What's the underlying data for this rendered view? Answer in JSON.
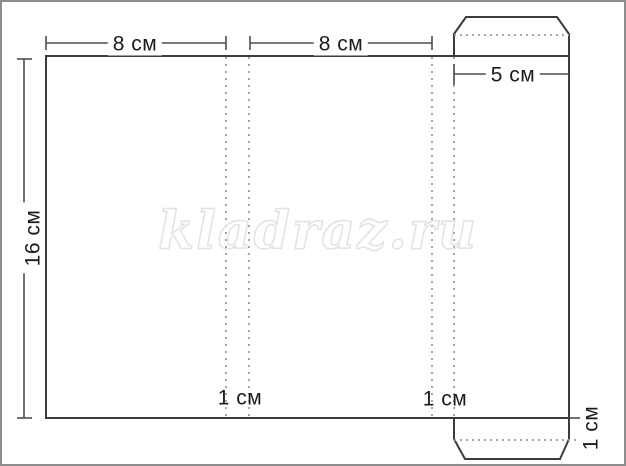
{
  "diagram": {
    "type": "papercraft-box-unfolding-pattern",
    "watermark": {
      "text": "kladraz.ru",
      "outline_color": "#e2e2e2"
    },
    "labels": {
      "panel_width_left": "8 см",
      "panel_width_middle": "8 см",
      "side_panel_width": "5 см",
      "pattern_height": "16 см",
      "fold_allowance_left": "1 см",
      "fold_allowance_right": "1 см",
      "bottom_flap_depth": "1 см"
    },
    "colors": {
      "background": "#ffffff",
      "frame": "#8d8d8d",
      "solid_line": "#3c3c3c",
      "dimension_line": "#4e4e4e",
      "fold_dashed_line": "#9c9c9c",
      "label_text": "#1b1b1b"
    }
  }
}
